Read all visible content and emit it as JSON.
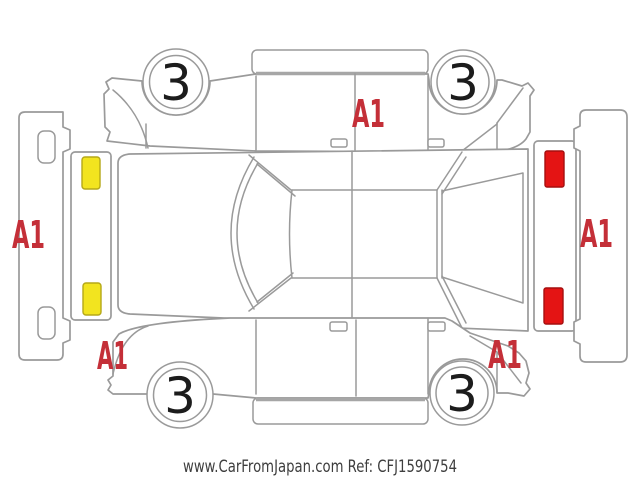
{
  "watermark": "www.CarFromJapan.com Ref: CFJ1590754",
  "diagram": {
    "kind": "vehicle-inspection-unfolded-diagram",
    "marks": {
      "front_bumper": "A1",
      "rear_bumper": "A1",
      "far_side": "A1",
      "near_side_front": "A1",
      "near_side_rear": "A1"
    },
    "wheels": [
      {
        "position": "far-side-front",
        "grade": "3"
      },
      {
        "position": "far-side-rear",
        "grade": "3"
      },
      {
        "position": "near-side-front",
        "grade": "3"
      },
      {
        "position": "near-side-rear",
        "grade": "3"
      }
    ],
    "colors": {
      "outline_gray": "#9a9a9a",
      "mark_red": "#c42f38",
      "headlight_yellow": "#f2e41f",
      "taillight_red": "#e41414",
      "watermark_gray": "#3e3e3e"
    }
  }
}
